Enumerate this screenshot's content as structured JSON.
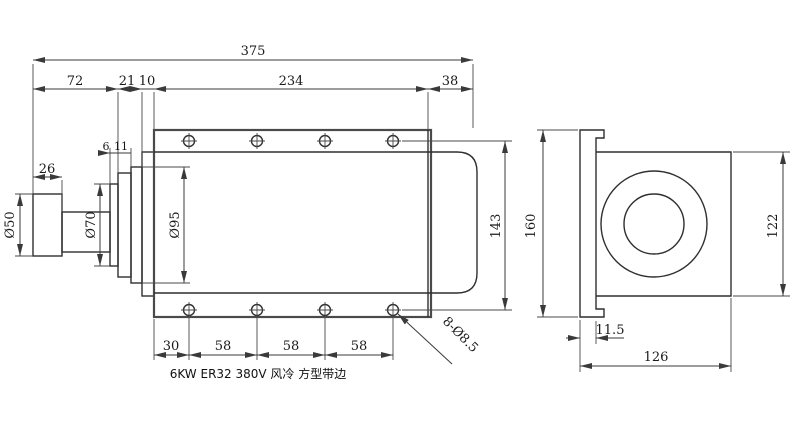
{
  "title": "6KW ER32 380V 风冷 方型带边",
  "front_view": {
    "top_dims": {
      "total_length": "375",
      "shaft_section": "72",
      "front_cap": "21",
      "front_plate": "10",
      "body_length": "234",
      "rear_cover": "38"
    },
    "shaft_dims": {
      "nut_length": "26",
      "collar_step": "6",
      "cap_step": "11",
      "nut_diameter": "Ø50",
      "collar_diameter": "Ø70",
      "front_flange_diameter": "Ø95"
    },
    "hole_dims": {
      "hole_row_spacing": "143",
      "edge_offset": "30",
      "pitches": [
        "58",
        "58",
        "58"
      ],
      "hole_callout": "8-Ø8.5"
    }
  },
  "side_view": {
    "dims": {
      "flange_height": "160",
      "body_height": "122",
      "flange_thickness": "11.5",
      "body_width": "126"
    }
  }
}
